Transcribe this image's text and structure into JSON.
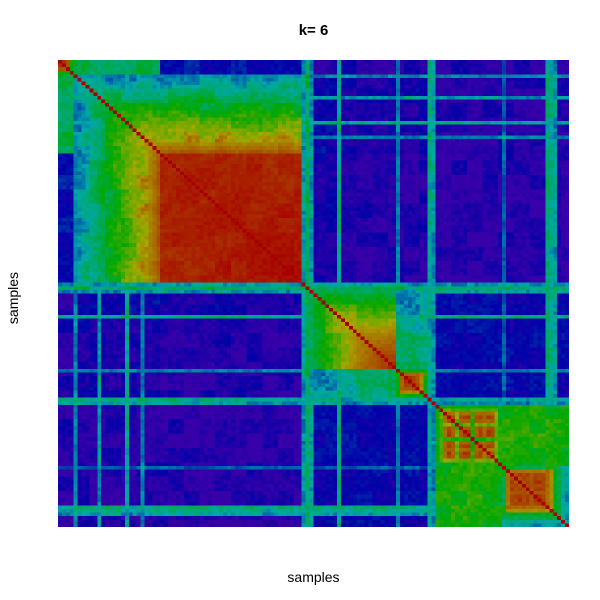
{
  "chart_data": {
    "type": "heatmap",
    "title": "k= 6",
    "xlabel": "samples",
    "ylabel": "samples",
    "k": 6,
    "n_samples": 130,
    "legend": "none",
    "axes_ticks": "none",
    "layout": {
      "plot_area": {
        "left": 58,
        "top": 60,
        "width": 511,
        "height": 467
      },
      "background": "#FFFFFF",
      "title_color": "#000000"
    },
    "colormap": {
      "description": "consensus 0..1 mapped to rainbow hue violet to red",
      "low": "#3800A8",
      "mid_cyan": "#00A8A8",
      "mid_green": "#00A800",
      "mid_orange": "#A85400",
      "high": "#A80000",
      "hue_start_deg": 260,
      "hue_end_deg": 0,
      "hsv_saturation": 1,
      "hsv_value": 0.66
    },
    "clusters": [
      {
        "id": 1,
        "sample_range_1based": [
          1,
          4
        ],
        "approx_consensus": 0.93
      },
      {
        "id": 2,
        "sample_range_1based": [
          5,
          62
        ],
        "approx_consensus": 0.97
      },
      {
        "id": 3,
        "sample_range_1based": [
          65,
          86
        ],
        "approx_consensus": 0.85
      },
      {
        "id": 4,
        "sample_range_1based": [
          87,
          94
        ],
        "approx_consensus": 0.9
      },
      {
        "id": 5,
        "sample_range_1based": [
          97,
          113
        ],
        "approx_consensus": 0.88
      },
      {
        "id": 6,
        "sample_range_1based": [
          114,
          130
        ],
        "approx_consensus": 0.85
      }
    ],
    "matrix_model": {
      "groups": [
        {
          "name": "cluster1",
          "cluster": 1,
          "range": [
            0,
            3
          ],
          "strengths": {
            "type": "list",
            "values": [
              0.93,
              0.96,
              0.9,
              0.55
            ]
          }
        },
        {
          "name": "cluster2-fringe",
          "cluster": 2,
          "range": [
            4,
            25
          ],
          "strengths": {
            "type": "ramp",
            "from": 0.25,
            "to": 0.88
          }
        },
        {
          "name": "cluster2-core",
          "cluster": 2,
          "range": [
            26,
            61
          ],
          "strengths": {
            "type": "ramp",
            "from": 0.95,
            "to": 0.98
          }
        },
        {
          "name": "noise-gap1",
          "cluster": 0,
          "range": [
            62,
            63
          ],
          "strengths": {
            "type": "const",
            "value": 0.08
          }
        },
        {
          "name": "cluster3-fringe",
          "cluster": 3,
          "range": [
            64,
            71
          ],
          "strengths": {
            "type": "ramp",
            "from": 0.45,
            "to": 0.7
          }
        },
        {
          "name": "cluster3-core",
          "cluster": 3,
          "range": [
            72,
            85
          ],
          "strengths": {
            "type": "ramp",
            "from": 0.78,
            "to": 0.94
          }
        },
        {
          "name": "cluster4",
          "cluster": 4,
          "range": [
            86,
            93
          ],
          "strengths": {
            "type": "list",
            "values": [
              0.5,
              0.85,
              0.93,
              0.95,
              0.93,
              0.9,
              0.82,
              0.55
            ]
          }
        },
        {
          "name": "noise-gap2",
          "cluster": 0,
          "range": [
            94,
            95
          ],
          "strengths": {
            "type": "const",
            "value": 0.1
          }
        },
        {
          "name": "cluster5",
          "cluster": 5,
          "range": [
            96,
            112
          ],
          "strengths": {
            "type": "list",
            "values": [
              0.5,
              0.62,
              0.85,
              0.92,
              0.88,
              0.7,
              0.9,
              0.95,
              0.93,
              0.6,
              0.88,
              0.92,
              0.86,
              0.95,
              0.9,
              0.72,
              0.55
            ]
          }
        },
        {
          "name": "cluster6",
          "cluster": 6,
          "range": [
            113,
            129
          ],
          "strengths": {
            "type": "list",
            "values": [
              0.5,
              0.85,
              0.93,
              0.9,
              0.95,
              0.9,
              0.93,
              0.88,
              0.92,
              0.95,
              0.9,
              0.85,
              0.8,
              0.45,
              0.4,
              0.35,
              0.3
            ]
          }
        }
      ],
      "base": [
        [
          0,
          0.45,
          0.1,
          0.05,
          0.03,
          0.03,
          0.025,
          0.025,
          0.025,
          0.025
        ],
        [
          0.45,
          0,
          0,
          0.07,
          0.08,
          0.05,
          0.05,
          0.06,
          0.03,
          0.03
        ],
        [
          0.1,
          0,
          0,
          0.06,
          0.05,
          0.03,
          0.02,
          0.02,
          0.02,
          0.02
        ],
        [
          0.05,
          0.07,
          0.06,
          0,
          0.3,
          0.18,
          0.12,
          0.12,
          0.06,
          0.05
        ],
        [
          0.03,
          0.08,
          0.05,
          0.3,
          0,
          0,
          0.28,
          0.15,
          0.07,
          0.06
        ],
        [
          0.03,
          0.05,
          0.03,
          0.18,
          0,
          0,
          0.38,
          0.15,
          0.08,
          0.07
        ],
        [
          0.025,
          0.05,
          0.02,
          0.12,
          0.28,
          0.38,
          0,
          0.2,
          0.08,
          0.08
        ],
        [
          0.025,
          0.06,
          0.02,
          0.12,
          0.15,
          0.15,
          0.2,
          0,
          0.22,
          0.18
        ],
        [
          0.025,
          0.03,
          0.02,
          0.06,
          0.07,
          0.08,
          0.08,
          0.22,
          0,
          0.55
        ],
        [
          0.025,
          0.03,
          0.02,
          0.05,
          0.06,
          0.07,
          0.08,
          0.18,
          0.55,
          0
        ]
      ],
      "stripes": {
        "4": 0.26,
        "10": 0.3,
        "17": 0.34,
        "21": 0.26,
        "62": 0.3,
        "63": 0.42,
        "64": 0.3,
        "71": 0.36,
        "86": 0.25,
        "94": 0.34,
        "95": 0.28,
        "113": 0.2,
        "124": 0.38,
        "125": 0.34,
        "126": 0.3
      },
      "noise": {
        "high_threshold": 0.8,
        "mid_threshold": 0.28,
        "fine_amp_high": 0.03,
        "fine_amp_mid": 0.1,
        "fine_amp_low": 0.05,
        "block_amp_high": 0.03,
        "block_amp_mid": 0.12,
        "block_amp_low": 0.07,
        "block_size": 4
      },
      "diagonal_value": 1.0
    }
  }
}
